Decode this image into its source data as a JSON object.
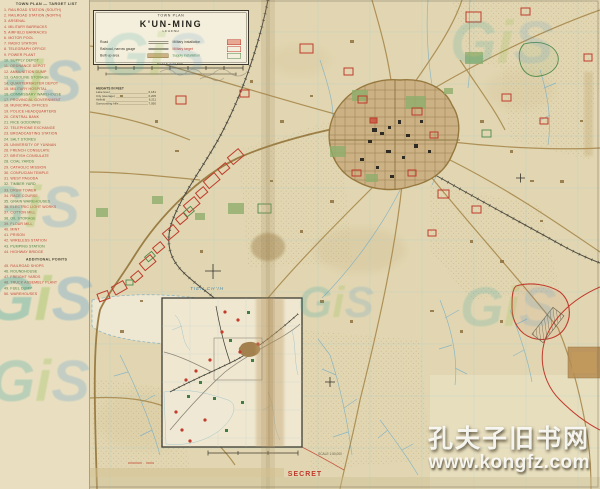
{
  "meta": {
    "security_label": "SECRET"
  },
  "colors": {
    "paper": "#e3d8b5",
    "margin_paper": "#e9dfc0",
    "panel": "#f4efdc",
    "military_red": "#c03b2c",
    "supply_green": "#4e8a4a",
    "water_blue": "#7fb0c4",
    "road_tan": "#a9894e",
    "builtup_tan": "#ccb184",
    "list_red": "#c44536",
    "list_green": "#4a7d3c",
    "gis_teal": "#2fa3a0",
    "gis_green": "#86b93f",
    "gis_blue": "#5b9ccc"
  },
  "title_box": {
    "kicker": "TOWN PLAN",
    "title": "K'UN-MING",
    "legend_heading": "LEGEND",
    "left_entries": [
      {
        "label": "Road",
        "symbol": "road"
      },
      {
        "label": "Railroad, narrow gauge",
        "symbol": "rail"
      },
      {
        "label": "Built-up area",
        "symbol": "built"
      }
    ],
    "right_entries": [
      {
        "label": "Military installation",
        "symbol": "red-filled",
        "color": "#3c382e"
      },
      {
        "label": "Military target",
        "symbol": "red-open",
        "color": "#c03b2c"
      },
      {
        "label": "Supply installation",
        "symbol": "green-open",
        "color": "#4e8a4a"
      }
    ],
    "scale_label": "SCALE 1:12,500"
  },
  "elevation_note": {
    "heading": "HEIGHTS IN FEET",
    "rows": [
      [
        "Lake level",
        "6,181"
      ],
      [
        "City (average)",
        "6,205"
      ],
      [
        "Airfield",
        "6,211"
      ],
      [
        "Surrounding hills",
        "7,050"
      ]
    ]
  },
  "target_list": {
    "heading": "TOWN PLAN — TARGET LIST",
    "items": [
      {
        "n": 1,
        "label": "RAILROAD STATION (SOUTH)",
        "color": "red"
      },
      {
        "n": 2,
        "label": "RAILROAD STATION (NORTH)",
        "color": "red"
      },
      {
        "n": 3,
        "label": "ARSENAL",
        "color": "red"
      },
      {
        "n": 4,
        "label": "MILITARY BARRACKS",
        "color": "red"
      },
      {
        "n": 5,
        "label": "AIRFIELD BARRACKS",
        "color": "red"
      },
      {
        "n": 6,
        "label": "MOTOR POOL",
        "color": "red"
      },
      {
        "n": 7,
        "label": "RADIO STATION",
        "color": "red"
      },
      {
        "n": 8,
        "label": "TELEGRAPH OFFICE",
        "color": "red"
      },
      {
        "n": 9,
        "label": "POWER PLANT",
        "color": "red"
      },
      {
        "n": 10,
        "label": "SUPPLY DEPOT",
        "color": "green"
      },
      {
        "n": 11,
        "label": "ORDNANCE DEPOT",
        "color": "red"
      },
      {
        "n": 12,
        "label": "AMMUNITION DUMP",
        "color": "red"
      },
      {
        "n": 13,
        "label": "GASOLINE STORAGE",
        "color": "green"
      },
      {
        "n": 14,
        "label": "QUARTERMASTER DEPOT",
        "color": "red"
      },
      {
        "n": 15,
        "label": "MILITARY HOSPITAL",
        "color": "red"
      },
      {
        "n": 16,
        "label": "COMMISSARY WAREHOUSE",
        "color": "green"
      },
      {
        "n": 17,
        "label": "PROVINCIAL GOVERNMENT",
        "color": "red"
      },
      {
        "n": 18,
        "label": "MUNICIPAL OFFICES",
        "color": "red"
      },
      {
        "n": 19,
        "label": "POLICE HEADQUARTERS",
        "color": "red"
      },
      {
        "n": 20,
        "label": "CENTRAL BANK",
        "color": "red"
      },
      {
        "n": 21,
        "label": "RICE GODOWNS",
        "color": "green"
      },
      {
        "n": 22,
        "label": "TELEPHONE EXCHANGE",
        "color": "red"
      },
      {
        "n": 23,
        "label": "BROADCASTING STATION",
        "color": "red"
      },
      {
        "n": 24,
        "label": "SALT STORES",
        "color": "green"
      },
      {
        "n": 25,
        "label": "UNIVERSITY OF YUNNAN",
        "color": "red"
      },
      {
        "n": 26,
        "label": "FRENCH CONSULATE",
        "color": "red"
      },
      {
        "n": 27,
        "label": "BRITISH CONSULATE",
        "color": "red"
      },
      {
        "n": 28,
        "label": "COAL YARDS",
        "color": "green"
      },
      {
        "n": 29,
        "label": "CATHOLIC MISSION",
        "color": "red"
      },
      {
        "n": 30,
        "label": "CONFUCIAN TEMPLE",
        "color": "red"
      },
      {
        "n": 31,
        "label": "WEST PAGODA",
        "color": "red"
      },
      {
        "n": 32,
        "label": "TIMBER YARD",
        "color": "green"
      },
      {
        "n": 33,
        "label": "DRUM TOWER",
        "color": "red"
      },
      {
        "n": 34,
        "label": "RACE COURSE",
        "color": "red"
      },
      {
        "n": 35,
        "label": "GRAIN WAREHOUSES",
        "color": "green"
      },
      {
        "n": 36,
        "label": "ELECTRIC LIGHT WORKS",
        "color": "red"
      },
      {
        "n": 37,
        "label": "COTTON MILL",
        "color": "red"
      },
      {
        "n": 38,
        "label": "OIL STORAGE",
        "color": "green"
      },
      {
        "n": 39,
        "label": "FLOUR MILL",
        "color": "red"
      },
      {
        "n": 40,
        "label": "MINT",
        "color": "red"
      },
      {
        "n": 41,
        "label": "PRISON",
        "color": "red"
      },
      {
        "n": 42,
        "label": "WIRELESS STATION",
        "color": "red"
      },
      {
        "n": 43,
        "label": "PUMPING STATION",
        "color": "green"
      },
      {
        "n": 44,
        "label": "HIGHWAY BRIDGE",
        "color": "red"
      }
    ],
    "sub_heading": "ADDITIONAL POINTS",
    "sub_items": [
      {
        "n": 45,
        "label": "RAILROAD SHOPS",
        "color": "red"
      },
      {
        "n": 46,
        "label": "ROUNDHOUSE",
        "color": "green"
      },
      {
        "n": 47,
        "label": "FREIGHT YARDS",
        "color": "red"
      },
      {
        "n": 48,
        "label": "TRUCK ASSEMBLY PLANT",
        "color": "red"
      },
      {
        "n": 49,
        "label": "FUEL DUMP",
        "color": "green"
      },
      {
        "n": 50,
        "label": "WAREHOUSES",
        "color": "red"
      }
    ]
  },
  "map_labels": {
    "lake": "TIEN CH'IH",
    "inset_scale": "SCALE 1:50,000"
  },
  "watermarks": {
    "gis": "GiS",
    "bookstore_line1": "孔夫子旧书网",
    "bookstore_line2": "www.kongfz.com"
  }
}
